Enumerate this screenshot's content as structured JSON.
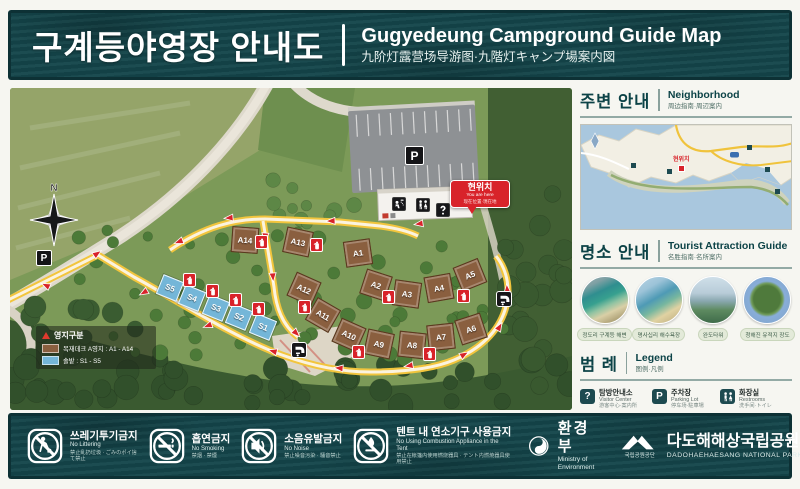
{
  "header": {
    "title_ko": "구계등야영장 안내도",
    "title_en": "Gugyedeung Campground Guide Map",
    "title_cjk": "九阶灯露营场导游图·九階灯キャンプ場案内図"
  },
  "map": {
    "north": "N",
    "parking_label": "P",
    "you_are_here": {
      "ko": "현위치",
      "en": "You are here",
      "cjk": "现在位置·現在地"
    },
    "site_legend": {
      "title": "영지구분",
      "rows": [
        {
          "color": "#8a5f3f",
          "label": "목재데크 A영지 : A1 - A14"
        },
        {
          "color": "#74b6d8",
          "label": "솔밭 : S1 - S5"
        }
      ]
    },
    "sites": [
      {
        "id": "A1",
        "x": 348,
        "y": 165,
        "r": -8,
        "t": "wood"
      },
      {
        "id": "A2",
        "x": 366,
        "y": 197,
        "r": 18,
        "t": "wood"
      },
      {
        "id": "A3",
        "x": 397,
        "y": 206,
        "r": 8,
        "t": "wood"
      },
      {
        "id": "A4",
        "x": 429,
        "y": 200,
        "r": -10,
        "t": "wood"
      },
      {
        "id": "A5",
        "x": 460,
        "y": 187,
        "r": -22,
        "t": "wood"
      },
      {
        "id": "A6",
        "x": 461,
        "y": 241,
        "r": -18,
        "t": "wood"
      },
      {
        "id": "A7",
        "x": 431,
        "y": 249,
        "r": -6,
        "t": "wood"
      },
      {
        "id": "A8",
        "x": 402,
        "y": 257,
        "r": 6,
        "t": "wood"
      },
      {
        "id": "A9",
        "x": 369,
        "y": 256,
        "r": 12,
        "t": "wood"
      },
      {
        "id": "A10",
        "x": 339,
        "y": 247,
        "r": 24,
        "t": "wood"
      },
      {
        "id": "A11",
        "x": 313,
        "y": 227,
        "r": 30,
        "t": "wood"
      },
      {
        "id": "A12",
        "x": 294,
        "y": 201,
        "r": 24,
        "t": "wood"
      },
      {
        "id": "A13",
        "x": 288,
        "y": 154,
        "r": 12,
        "t": "wood"
      },
      {
        "id": "A14",
        "x": 235,
        "y": 152,
        "r": 4,
        "t": "wood"
      },
      {
        "id": "S1",
        "x": 253,
        "y": 239,
        "r": 22,
        "t": "pine"
      },
      {
        "id": "S2",
        "x": 229,
        "y": 229,
        "r": 22,
        "t": "pine"
      },
      {
        "id": "S3",
        "x": 206,
        "y": 220,
        "r": 22,
        "t": "pine"
      },
      {
        "id": "S4",
        "x": 182,
        "y": 210,
        "r": 22,
        "t": "pine"
      },
      {
        "id": "S5",
        "x": 160,
        "y": 200,
        "r": 22,
        "t": "pine"
      }
    ],
    "fire_points": [
      [
        250,
        153
      ],
      [
        305,
        156
      ],
      [
        178,
        191
      ],
      [
        201,
        202
      ],
      [
        224,
        211
      ],
      [
        247,
        220
      ],
      [
        293,
        218
      ],
      [
        377,
        208
      ],
      [
        452,
        207
      ],
      [
        347,
        263
      ],
      [
        418,
        265
      ]
    ],
    "fountains": [
      [
        288,
        261
      ],
      [
        493,
        210
      ]
    ],
    "parking_badges": [
      {
        "x": 403,
        "y": 66,
        "big": true
      },
      {
        "x": 34,
        "y": 170,
        "big": false
      }
    ],
    "arrows": [
      [
        35,
        197,
        205
      ],
      [
        88,
        165,
        -35
      ],
      [
        133,
        205,
        150
      ],
      [
        197,
        238,
        160
      ],
      [
        262,
        263,
        195
      ],
      [
        328,
        280,
        185
      ],
      [
        398,
        278,
        170
      ],
      [
        455,
        266,
        -30
      ],
      [
        490,
        238,
        -60
      ],
      [
        497,
        200,
        -95
      ],
      [
        168,
        154,
        160
      ],
      [
        218,
        130,
        175
      ],
      [
        320,
        133,
        178
      ],
      [
        408,
        136,
        172
      ],
      [
        255,
        150,
        95
      ],
      [
        263,
        190,
        85
      ],
      [
        287,
        246,
        45
      ]
    ]
  },
  "sidebar": {
    "neighborhood": {
      "title_ko": "주변 안내",
      "title_en": "Neighborhood",
      "title_cjk": "周边指南·周辺案内",
      "you_are_here": "현위치"
    },
    "attractions": {
      "title_ko": "명소 안내",
      "title_en": "Tourist Attraction Guide",
      "title_cjk": "名胜指南·名所案内",
      "items": [
        {
          "caption": "정도리 구계등 해변",
          "photo": "beach1"
        },
        {
          "caption": "명사십리 해수욕장",
          "photo": "beach2"
        },
        {
          "caption": "완도타워",
          "photo": "tower"
        },
        {
          "caption": "청해진 유적지 장도",
          "photo": "island"
        }
      ]
    },
    "legend": {
      "title_ko": "범 례",
      "title_en": "Legend",
      "title_cjk": "图例·凡例",
      "items": [
        {
          "icon": "info",
          "ko": "탐방안내소",
          "en": "Visitor Center",
          "cjk": "游客中心·案内所"
        },
        {
          "icon": "parking",
          "ko": "주차장",
          "en": "Parking Lot",
          "cjk": "停车场·駐車場"
        },
        {
          "icon": "restroom",
          "ko": "화장실",
          "en": "Restrooms",
          "cjk": "洗手间·トイレ"
        },
        {
          "icon": "fountain",
          "ko": "음수대",
          "en": "Drinking Fountain",
          "cjk": "饮水台·水飲み場"
        },
        {
          "icon": "shower",
          "ko": "샤워장",
          "en": "Shower Room",
          "cjk": "淋浴间·シャワー室"
        },
        {
          "icon": "exit",
          "ko": "대피로",
          "en": "Emergency Exit Route",
          "cjk": "避难路·避難路"
        },
        {
          "icon": "fire",
          "ko": "소화기",
          "en": "Fire Extinguisher",
          "cjk": "灭火器·消火器"
        }
      ]
    }
  },
  "footer": {
    "rules": [
      {
        "icon": "litter",
        "ko": "쓰레기투기금지",
        "en": "No Littering",
        "cjk": "禁止乱扔垃圾 · ごみのポイ捨て禁止"
      },
      {
        "icon": "smoke",
        "ko": "흡연금지",
        "en": "No Smoking",
        "cjk": "禁烟 · 禁煙"
      },
      {
        "icon": "noise",
        "ko": "소음유발금지",
        "en": "No Noise",
        "cjk": "禁止噪音污染 · 騒音禁止"
      },
      {
        "icon": "burn",
        "ko": "텐트 내 연소기구 사용금지",
        "en": "No Using Combustion Appliance in the Tent",
        "cjk": "禁止在帐篷内使用燃烧器具 · テント内燃焼器具使用禁止"
      }
    ],
    "ministry": {
      "ko": "환경부",
      "en": "Ministry of Environment"
    },
    "park": {
      "org": "국립공원공단",
      "ko": "다도해해상국립공원사무소",
      "en": "DADOHAEHAESANG NATIONAL PARK OFFICE"
    }
  },
  "colors": {
    "band_teal": "#14464b",
    "accent_teal": "#0c4347",
    "alert_red": "#d8232a",
    "road_yellow": "#f2c53d",
    "site_wood": "#8a5f3f",
    "site_pine": "#74b6d8"
  }
}
